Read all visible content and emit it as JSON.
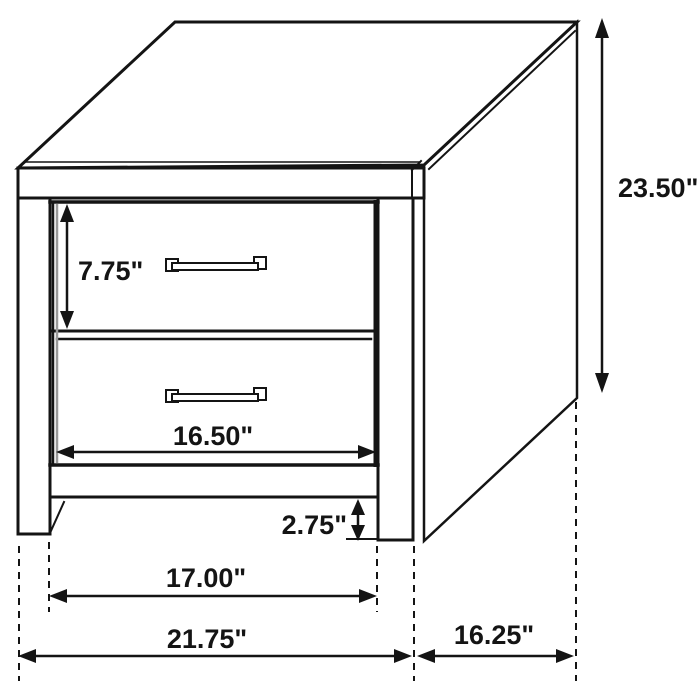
{
  "diagram": {
    "title": "Two-drawer nightstand dimension drawing",
    "unit": "inches",
    "labels": {
      "drawer_height": "7.75\"",
      "drawer_opening_width": "16.50\"",
      "overall_height": "23.50\"",
      "foot_height": "2.75\"",
      "between_legs_width": "17.00\"",
      "overall_width": "21.75\"",
      "depth": "16.25\""
    },
    "colors": {
      "line": "#141414",
      "background": "#ffffff",
      "shade": "#999999"
    }
  }
}
